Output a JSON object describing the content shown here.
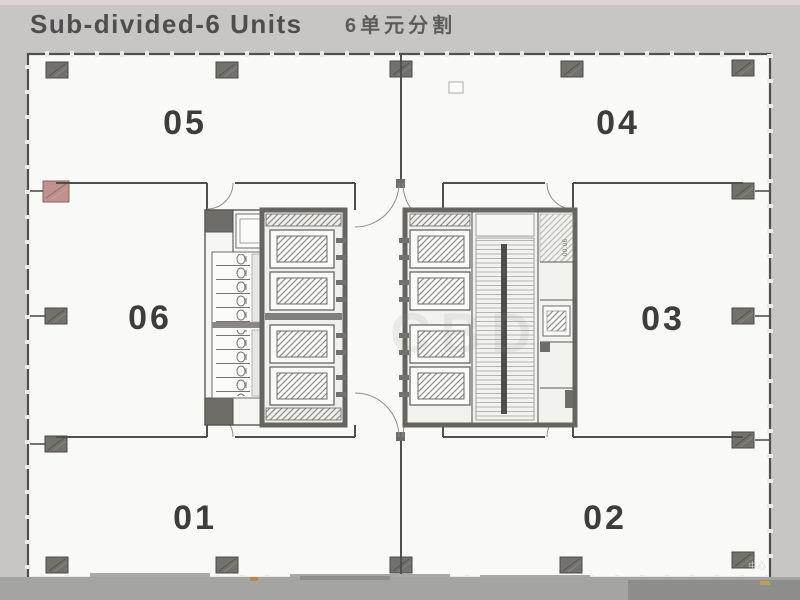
{
  "title": {
    "main": "Sub-divided-6 Units",
    "sub": "6单元分割"
  },
  "units": [
    {
      "label": "05"
    },
    {
      "label": "04"
    },
    {
      "label": "06"
    },
    {
      "label": "03"
    },
    {
      "label": "01"
    },
    {
      "label": "02"
    }
  ],
  "core": {
    "stair_label": "00.06"
  },
  "watermark": {
    "center": "CBD",
    "corner": "中心"
  },
  "colors": {
    "background": "#c7c6c4",
    "floor": "#f9f9f7",
    "wall": "#4f4f4d",
    "core_wall": "#67655f",
    "column": "#73716c",
    "accent_column": "#bd928f",
    "bottom_band": "#a4a4a2"
  }
}
